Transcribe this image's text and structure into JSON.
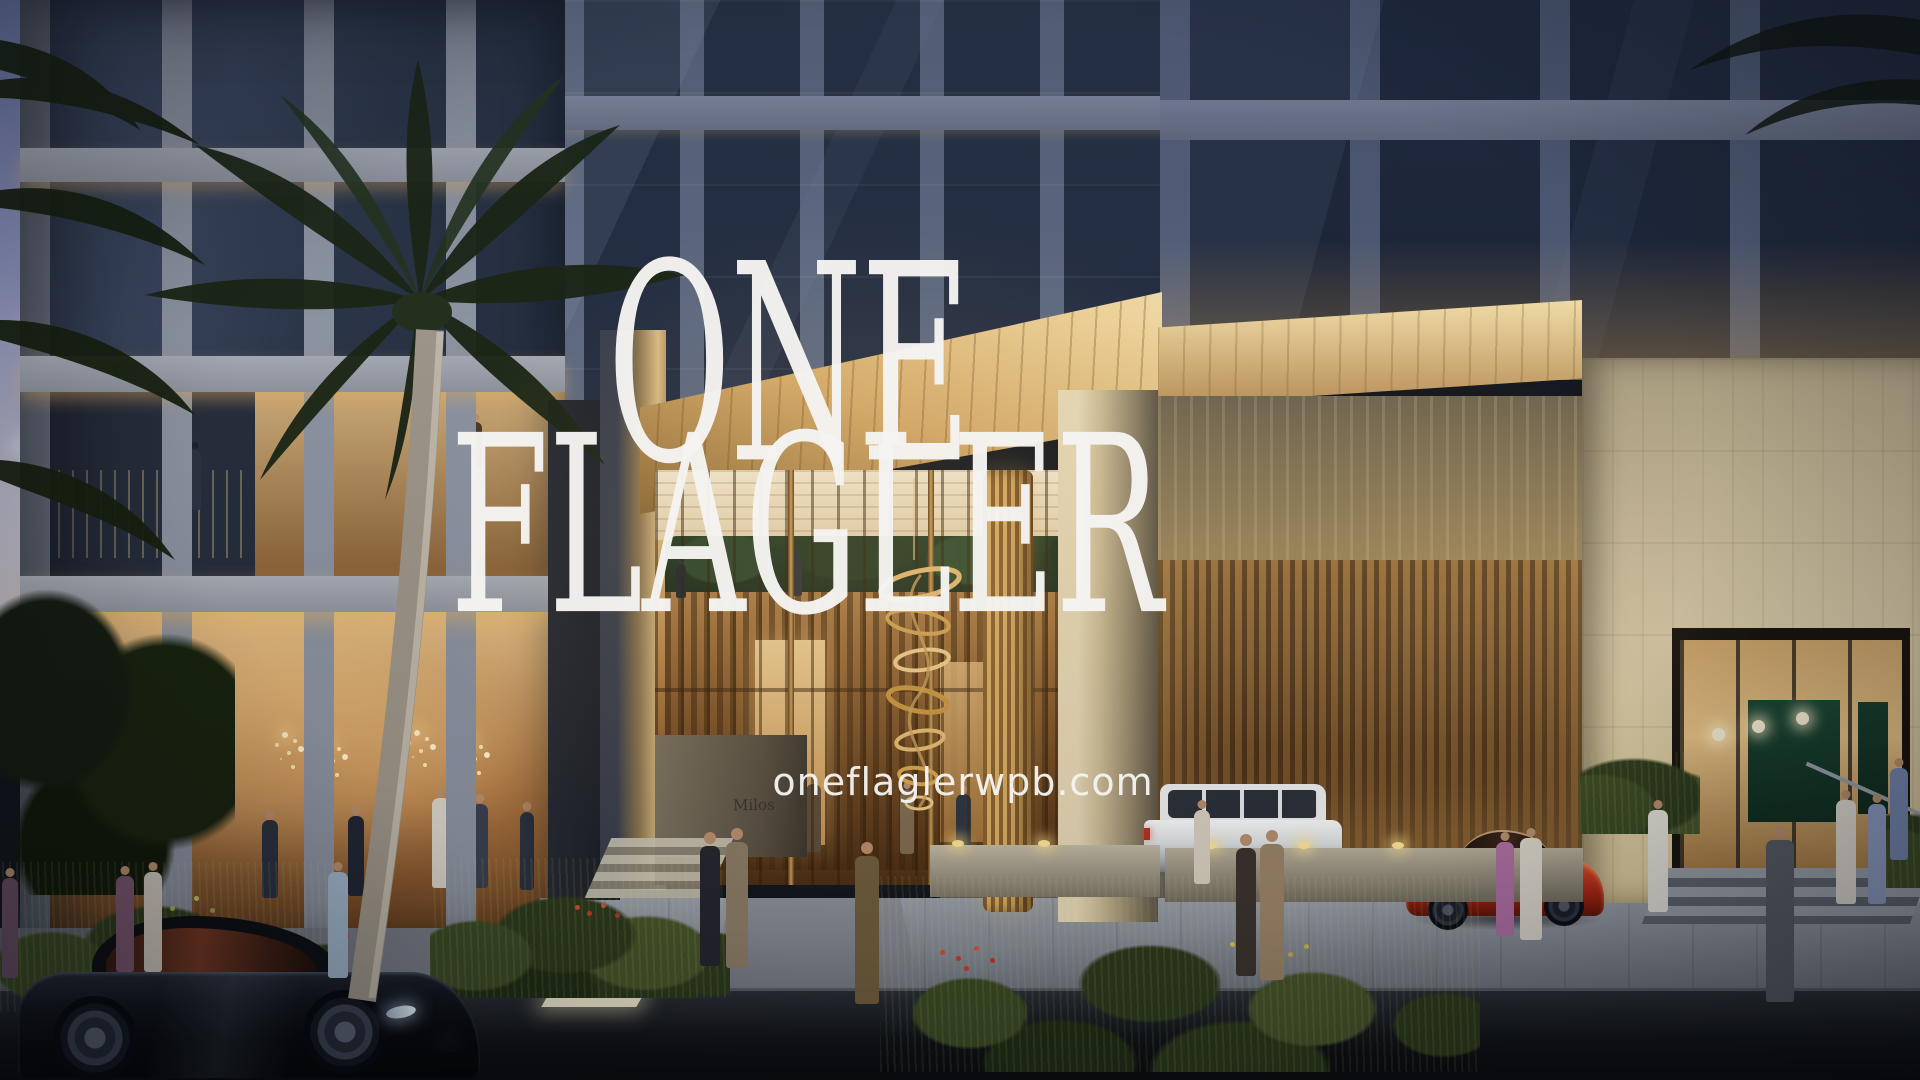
{
  "overlay": {
    "title_line1": "ONE",
    "title_line2": "FLAGLER",
    "website": "oneflaglerwpb.com"
  },
  "signage": {
    "restaurant": "Milos"
  },
  "palette": {
    "sky_top": "#6f7aae",
    "sky_bottom": "#c9c4c9",
    "glass_dark": "#222c40",
    "pier_gray": "#5c6880",
    "stone_warm": "#cfc0a0",
    "gold_soffit": "#e8c98c",
    "lobby_amber": "#c99b5e",
    "wood_slat": "#8a5c2e",
    "foliage_dark": "#1b2616",
    "street": "#0e1116",
    "car_black": "#0b0e13",
    "car_red": "#c63420",
    "suv_white": "#e9eaec",
    "text_white": "#f4f3f1"
  }
}
